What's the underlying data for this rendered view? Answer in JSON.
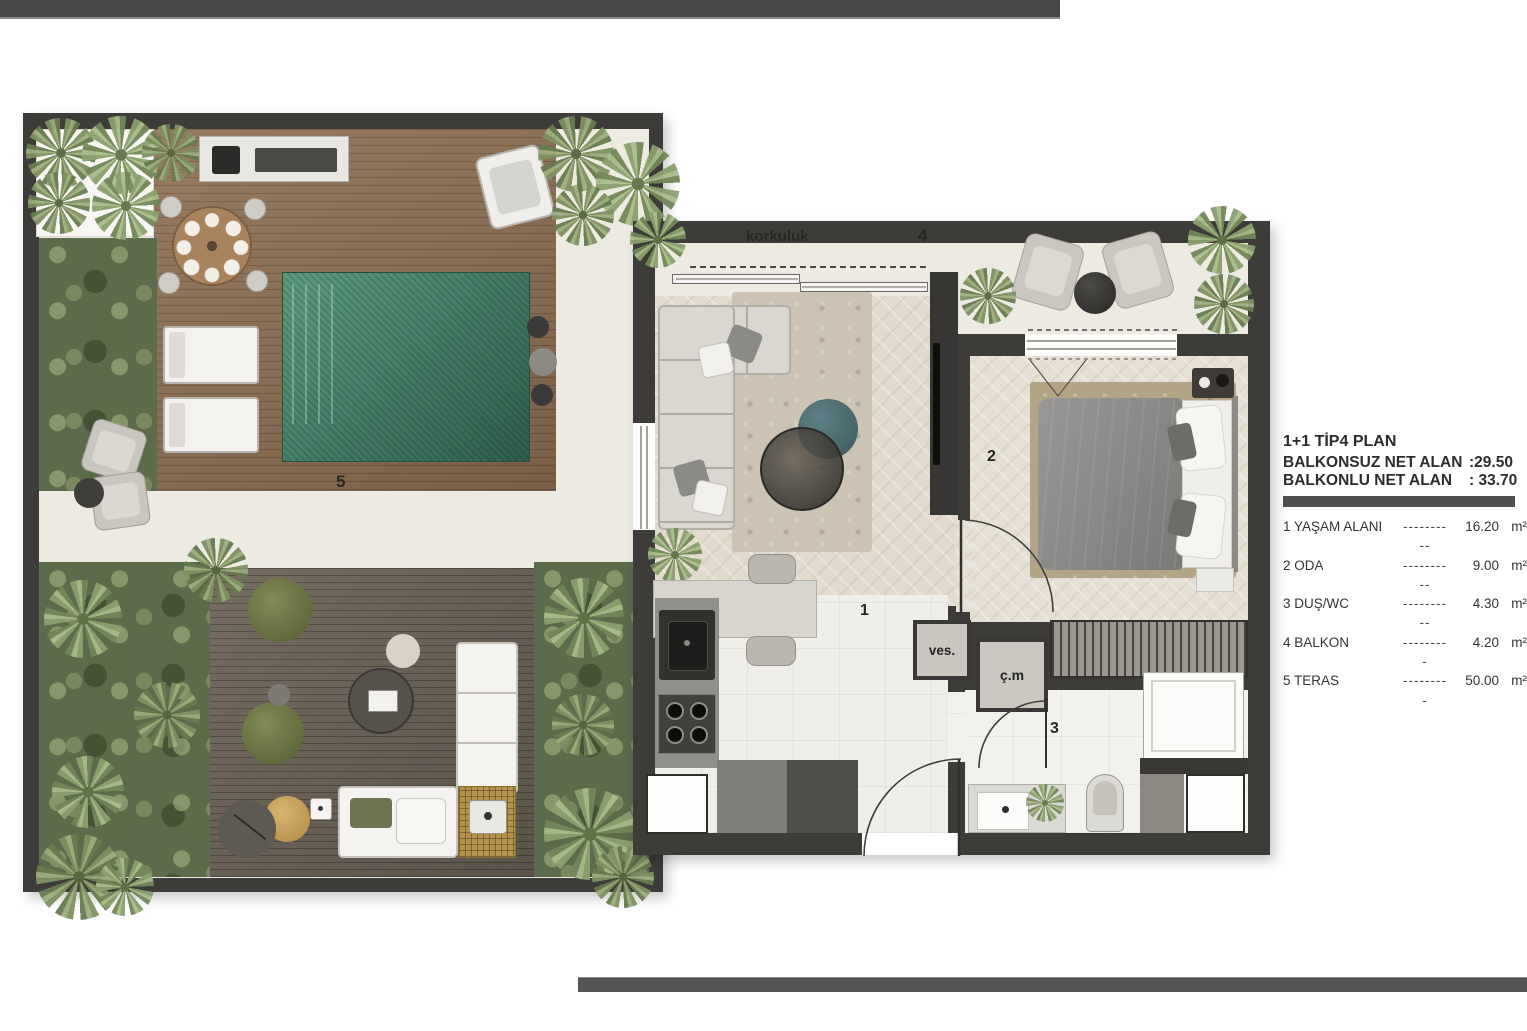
{
  "plan": {
    "rooms": {
      "living": {
        "num": "1"
      },
      "bedroom": {
        "num": "2"
      },
      "bath": {
        "num": "3"
      },
      "balcony": {
        "num": "4"
      },
      "terrace": {
        "num": "5"
      }
    },
    "labels": {
      "railing": "korkuluk",
      "vestibule": "ves.",
      "laundry": "ç.m"
    }
  },
  "legend": {
    "title": "1+1 TİP4 PLAN",
    "areas": [
      {
        "label": "BALKONSUZ NET ALAN",
        "value": ":29.50",
        "unit": "M²"
      },
      {
        "label": "BALKONLU NET ALAN",
        "value": ": 33.70",
        "unit": "M²"
      }
    ],
    "items": [
      {
        "label": "1 YAŞAM ALANI",
        "dots": "----------",
        "value": "16.20",
        "unit": "m²"
      },
      {
        "label": "2 ODA",
        "dots": "----------",
        "value": "9.00",
        "unit": "m²"
      },
      {
        "label": "3 DUŞ/WC",
        "dots": "----------",
        "value": "4.30",
        "unit": "m²"
      },
      {
        "label": "4 BALKON",
        "dots": "---------",
        "value": "4.20",
        "unit": "m²"
      },
      {
        "label": "5 TERAS",
        "dots": "---------",
        "value": "50.00",
        "unit": "m²"
      }
    ]
  },
  "colors": {
    "wall": "#3e3c39",
    "floor_cream": "#edeae2",
    "wood_deck": "#8a6d51",
    "wood_deck_dark": "#6e6559",
    "pool_green": "#47806a",
    "greenery": "#5c6b4b",
    "divider_bar": "#4f4f4f"
  }
}
